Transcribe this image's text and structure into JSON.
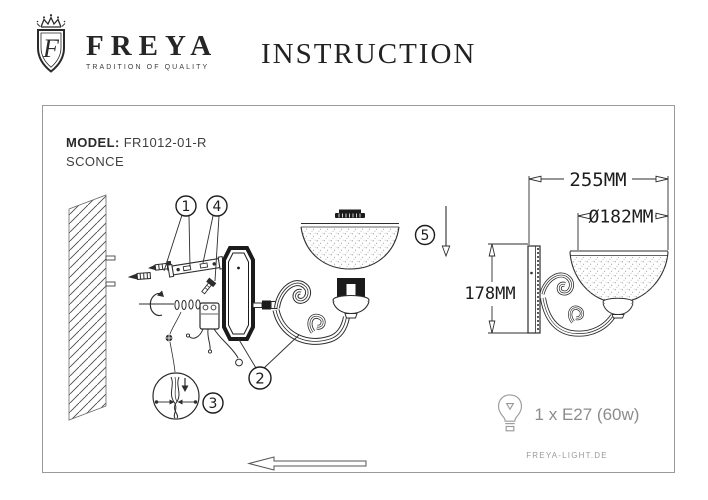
{
  "header": {
    "brand": "FREYA",
    "tagline": "TRADITION OF QUALITY",
    "title": "INSTRUCTION",
    "crest_monogram": "F"
  },
  "main_panel": {
    "model_label": "MODEL:",
    "model_value": "FR1012-01-R",
    "product_type": "SCONCE",
    "callouts": {
      "c1": "1",
      "c2": "2",
      "c3": "3",
      "c4": "4",
      "c5": "5"
    }
  },
  "dimensions_panel": {
    "width_label": "255MM",
    "diameter_label": "Ø182MM",
    "height_label": "178MM"
  },
  "bulb_panel": {
    "bulb_spec": "1 x E27 (60w)",
    "website": "FREYA-LIGHT.DE"
  },
  "colors": {
    "line": "#2d2d2d",
    "panel_border": "#9b9b9b",
    "muted_text": "#8c8c8c"
  }
}
